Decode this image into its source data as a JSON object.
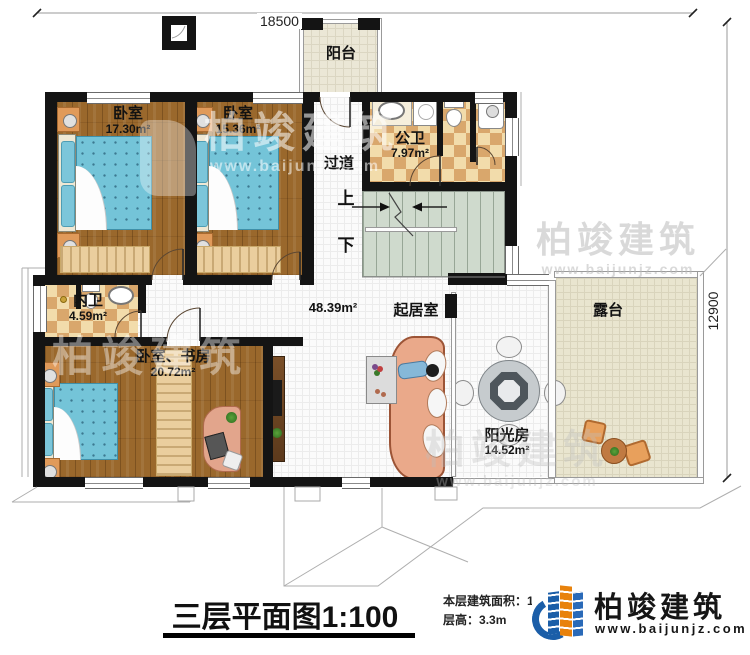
{
  "dimensions": {
    "width_top": "18500",
    "height_right": "12900"
  },
  "rooms": {
    "balcony": {
      "label": "阳台"
    },
    "bedroom_a": {
      "label": "卧室",
      "area": "17.30m²"
    },
    "bedroom_b": {
      "label": "卧室",
      "area": "15.36m²"
    },
    "public_bathroom": {
      "label": "公卫",
      "area": "7.97m²"
    },
    "corridor": {
      "label": "过道"
    },
    "inner_bathroom": {
      "label": "内卫",
      "area": "4.59m²"
    },
    "bedroom_study": {
      "label": "卧室、书房",
      "area": "20.72m²"
    },
    "living_room": {
      "label": "起居室",
      "area": "48.39m²"
    },
    "sunroom": {
      "label": "阳光房",
      "area": "14.52m²"
    },
    "terrace": {
      "label": "露台"
    }
  },
  "stairs": {
    "up_label": "上",
    "down_label": "下"
  },
  "title": "三层平面图1:100",
  "notes": {
    "floor_area_label": "本层建筑面积：",
    "floor_area_value": "137.2㎡",
    "floor_height_label": "层高：",
    "floor_height_value": "3.3m"
  },
  "brand": {
    "name": "柏竣建筑",
    "website": "www.baijunjz.com"
  },
  "watermark": {
    "name": "柏竣建筑",
    "website": "www.baijunjz.com"
  },
  "colors": {
    "wall": "#141414",
    "wood_floor": "#9a682c",
    "checker_light": "#f2dcab",
    "checker_dark": "#d9a76c",
    "stairs_floor": "#cfdacd",
    "terrace_floor": "#e9e5cf",
    "balcony_floor": "#ebe7d6",
    "bed_blue": "#74c4d8",
    "sofa_salmon": "#eaa98a",
    "brand_blue": "#1b5ea8",
    "brand_orange": "#e8820c"
  }
}
